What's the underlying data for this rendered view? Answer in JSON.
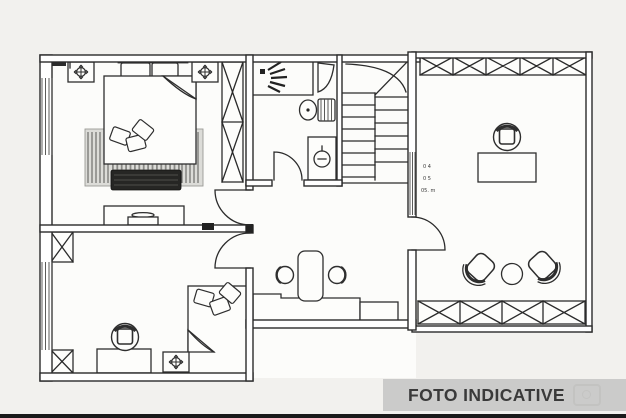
{
  "watermark": {
    "text": "FOTO INDICATIVE"
  },
  "plan": {
    "type": "architectural-floor-plan-top-view",
    "area_label": {
      "rotated_tiny_text": true,
      "lines": [
        "0 4",
        "0 5",
        "05. m"
      ]
    },
    "rooms": [
      {
        "name": "bedroom-top-left",
        "furniture": [
          "double-bed",
          "headboard",
          "pillows",
          "rug",
          "bench",
          "dresser",
          "ceiling-light",
          "ceiling-light",
          "tall-wardrobe",
          "window"
        ]
      },
      {
        "name": "bathroom",
        "furniture": [
          "shower",
          "shower-head",
          "toilet",
          "washbasin",
          "door"
        ]
      },
      {
        "name": "staircase",
        "furniture": [
          "stair-treads",
          "break-line"
        ]
      },
      {
        "name": "hallway-study",
        "furniture": [
          "desk-counter",
          "stool",
          "stool",
          "cabinet",
          "threshold-step"
        ]
      },
      {
        "name": "bedroom-bottom-left",
        "furniture": [
          "single-bed",
          "pillows",
          "desk",
          "office-chair",
          "ceiling-light",
          "wardrobe-box",
          "wardrobe-box",
          "window"
        ]
      },
      {
        "name": "living-office-right",
        "furniture": [
          "wardrobe-row-top",
          "desk",
          "office-chair",
          "armchair",
          "armchair",
          "round-table",
          "wardrobe-row-bottom",
          "door",
          "window-strip"
        ]
      }
    ]
  },
  "colors": {
    "line": "#2b2b2b",
    "background": "#f2f1ee",
    "paper": "#fcfcfa",
    "watermark_band": "#c9c9c8",
    "watermark_text": "#3a3a3a",
    "bottom_edge": "#1a1a1a"
  }
}
